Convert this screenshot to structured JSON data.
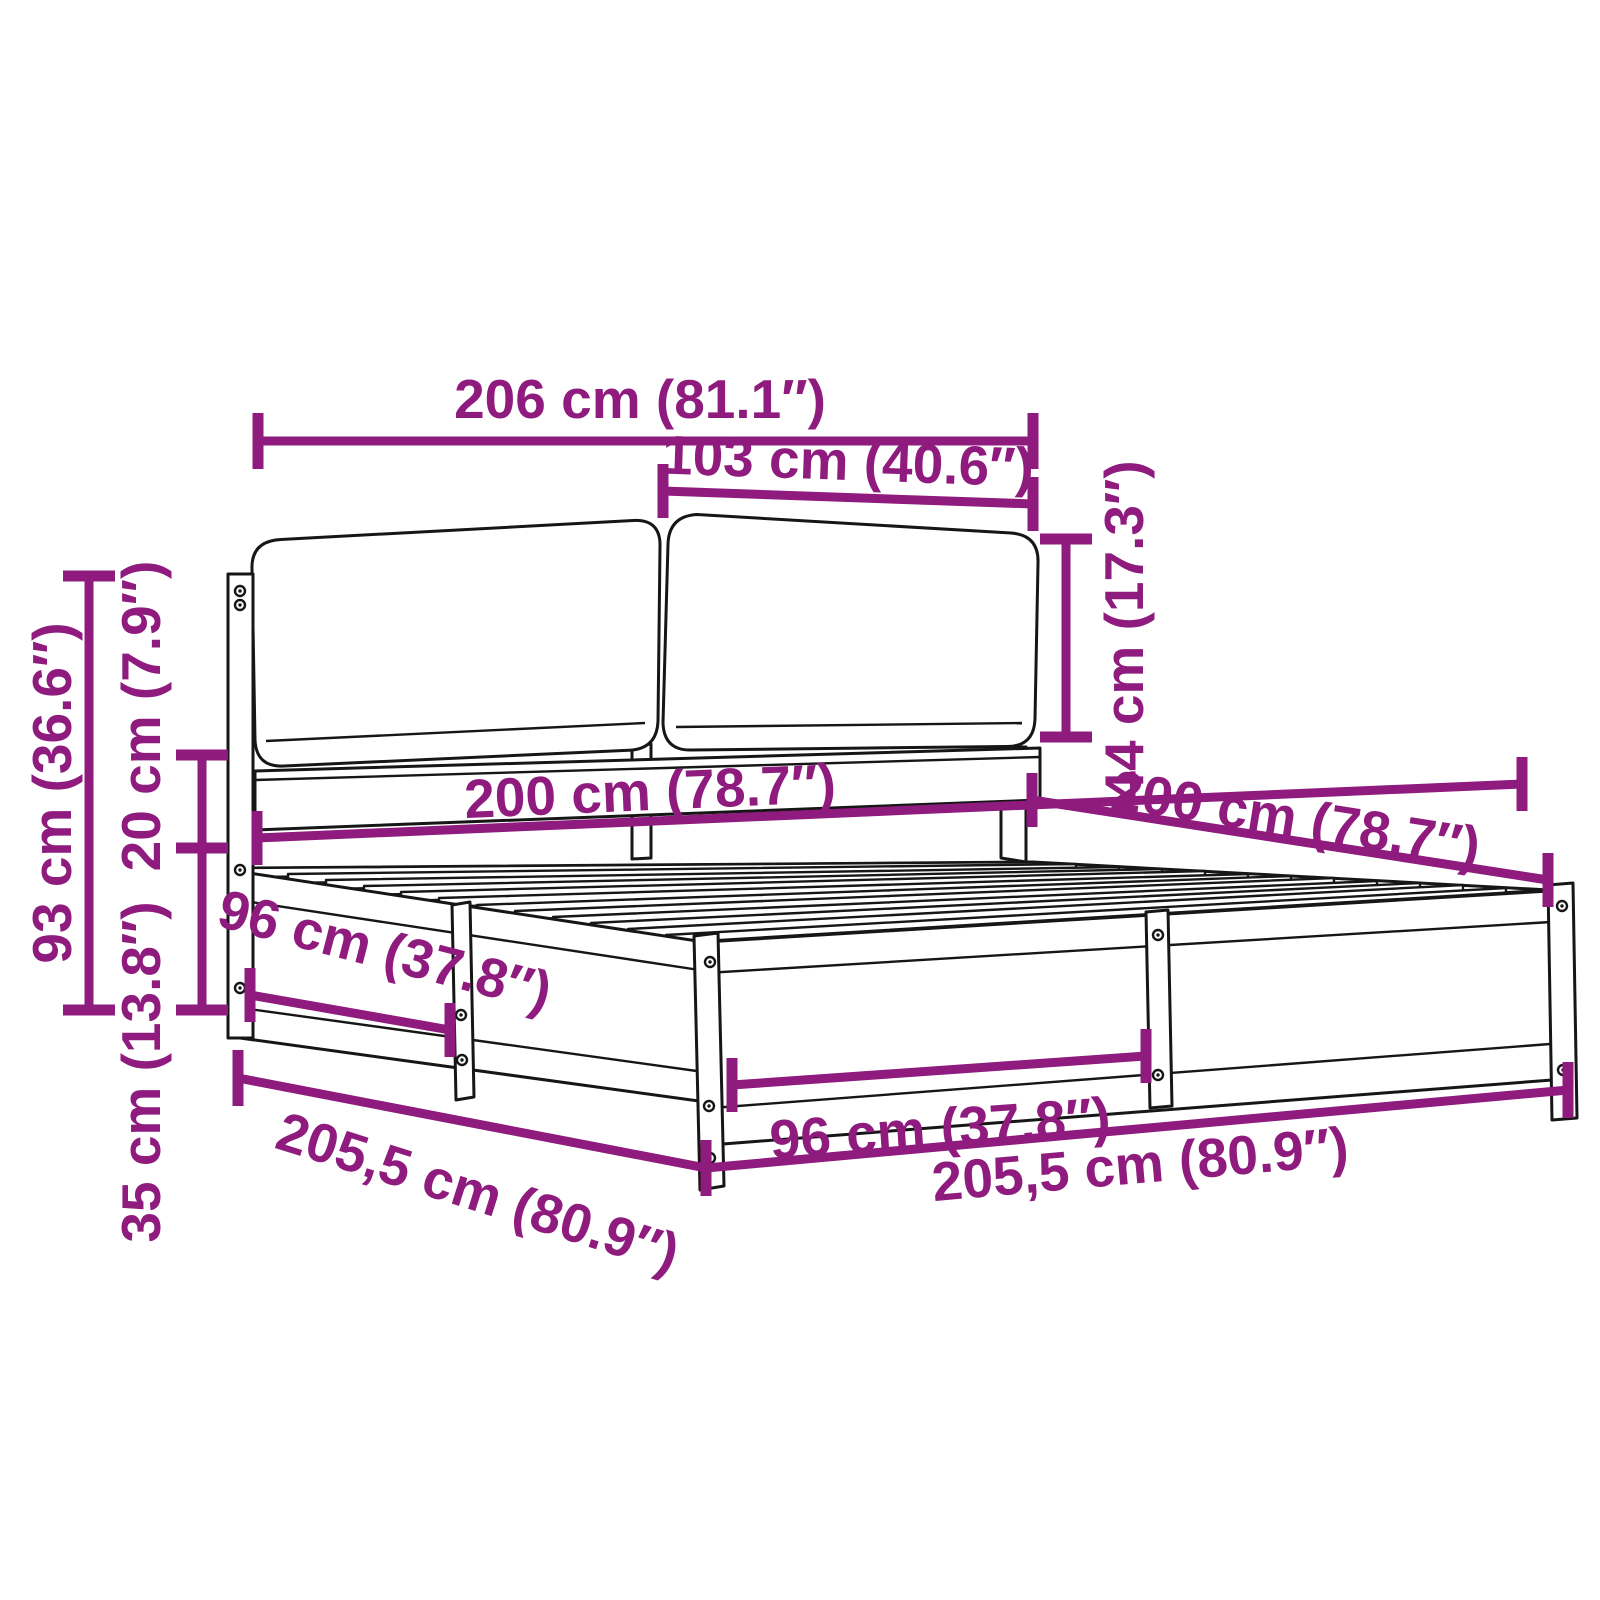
{
  "diagram": {
    "title": "bed-frame-dimension-diagram",
    "accent_color": "#8E1B7D",
    "line_color": "#161616",
    "background_color": "#ffffff",
    "dimensions": {
      "overall_width": "206 cm (81.1″)",
      "cushion_width": "103 cm (40.6″)",
      "cushion_height": "44 cm (17.3″)",
      "headboard_height": "93 cm (36.6″)",
      "rail_height": "20 cm (7.9″)",
      "base_height": "35 cm (13.8″)",
      "mattress_width": "200 cm (78.7″)",
      "mattress_depth": "200 cm (78.7″)",
      "side_bay_width": "96 cm (37.8″)",
      "front_bay_width": "96 cm (37.8″)",
      "frame_side_length": "205,5 cm (80.9″)",
      "frame_front_length": "205,5 cm (80.9″)"
    }
  }
}
